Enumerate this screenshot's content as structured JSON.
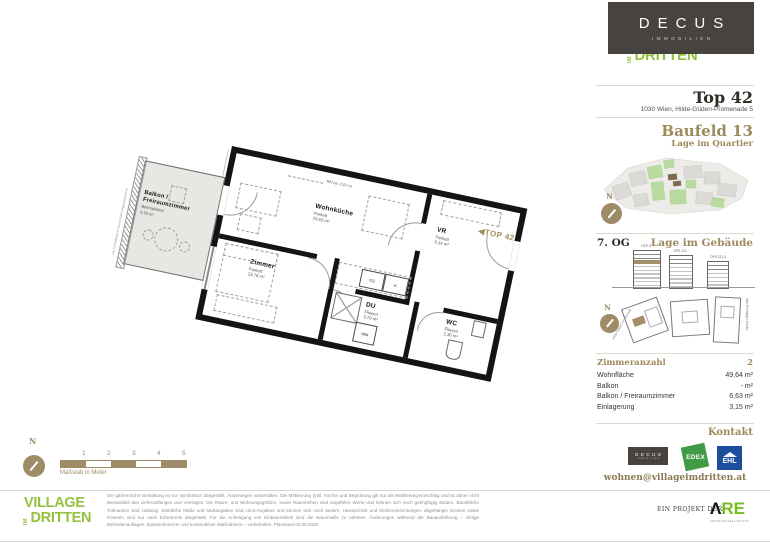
{
  "colors": {
    "accent_gold": "#9C8A5C",
    "brand_dark": "#474340",
    "village_green": "#94C13D",
    "edex_green": "#3F9B46",
    "ehl_blue": "#1D4E9E",
    "are_green": "#76BC21"
  },
  "brand": {
    "name": "DECUS",
    "subtitle": "IMMOBILIEN"
  },
  "village_logo": {
    "line1": "VILLAGE",
    "im": "IM",
    "line2": "DRITTEN"
  },
  "unit": {
    "title": "Top 42",
    "address": "1030 Wien, Hilde-Güden-Promenade 5"
  },
  "quartier": {
    "title": "Baufeld 13",
    "subtitle": "Lage im Quartier",
    "north": "N"
  },
  "gebaeude": {
    "floor": "7. OG",
    "title": "Lage im Gebäude",
    "north": "N",
    "buildings": [
      {
        "label": "HGP 5"
      },
      {
        "label": "OPS 123"
      },
      {
        "label": "OPS 121-3"
      }
    ],
    "streets": {
      "left": "Hilde-Güden-Promenade",
      "right": "Otto-Preminger-Straße"
    }
  },
  "details": {
    "rows": [
      {
        "label": "Zimmeranzahl",
        "value": "2"
      },
      {
        "label": "Wohnfläche",
        "value": "49,64 m²"
      },
      {
        "label": "Balkon",
        "value": "- m²"
      },
      {
        "label": "Balkon / Freiraumzimmer",
        "value": "6,63 m²"
      },
      {
        "label": "Einlagerung",
        "value": "3,15 m²"
      }
    ]
  },
  "kontakt": {
    "title": "Kontakt",
    "email": "wohnen@villageimdritten.at",
    "logos": {
      "decus": {
        "name": "DECUS",
        "sub": "IMMOBILIEN"
      },
      "edex": "EDEX",
      "ehl": "EHL"
    }
  },
  "plan": {
    "rooms": [
      {
        "name": "Wohnküche",
        "finish": "Parkett",
        "area": "20,63 m²"
      },
      {
        "name": "Zimmer",
        "finish": "Parkett",
        "area": "13,78 m²"
      },
      {
        "name": "VR",
        "finish": "Parkett",
        "area": "6,14 m²"
      },
      {
        "name": "DU",
        "finish": "Fliesen",
        "area": "3,79 m²"
      },
      {
        "name": "WC",
        "finish": "Fliesen",
        "area": "2,30 m²"
      },
      {
        "name": "Balkon / Freiraumzimmer",
        "finish": "Betonplatten",
        "area": "6,63 m²"
      }
    ],
    "annotations": {
      "room_height": "RH ca. 2,57 m",
      "gs": "GS",
      "k": "K",
      "wm": "WM",
      "shading": "verschiebbare Verschattungselemente",
      "top_arrow": "◀",
      "top_label": "TOP 42"
    },
    "scale": {
      "north": "N",
      "ticks": [
        "1",
        "2",
        "3",
        "4",
        "5"
      ],
      "caption": "Maßstab in Meter"
    }
  },
  "footer": {
    "disclaimer": "Die gärtnerische Gestaltung ist nur symbolisch dargestellt. Änderungen vorbehalten. Die Möblierung (inkl. Küche) und Begrünung gilt nur als Möblierungsvorschlag und ist daher nicht Bestandteil des Lieferumfanges und Vertrages. Die Raum- und Wohnungsgrößen, sowie Raumhöhen sind ungefähre Werte und können sich noch geringfügig ändern. Bauübliche Toleranzen sind zulässig. Sämtliche Maße und Maßangaben sind circa-Angaben und können sich noch ändern. Haustechnik und Elektroeinrichtungen, abgehängte Decken sowie Poterien sind nur nach Erfordernis dargestellt. Für die Anfertigung von Einbaumöbeln sind die Naturmaße zu nehmen. Änderungen während der Bauausführung – infolge Behördenauflagen, haustechnischer und konstruktiver Maßnahmen – vorbehalten. Planstand 04.09.2025",
    "project_prefix": "EIN PROJEKT DER",
    "are": {
      "glyph": "Λ",
      "text": "RE",
      "sub": "AUSTRIAN REAL ESTATE"
    }
  }
}
